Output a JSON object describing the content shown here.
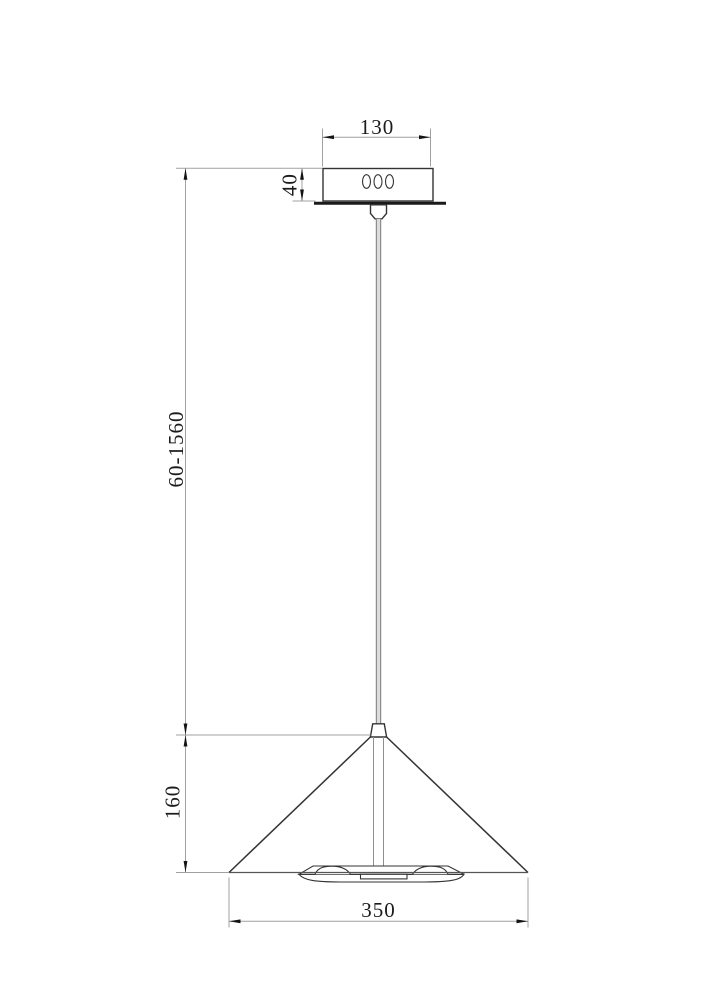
{
  "drawing": {
    "kind": "pendant-lamp-dimension-drawing",
    "dimensions": {
      "canopy_width": "130",
      "canopy_height": "40",
      "suspension_length": "60-1560",
      "shade_height": "160",
      "shade_diameter": "350"
    }
  },
  "colors": {
    "line": "#333333",
    "thick": "#1a1a1a",
    "dim": "#a1a1a1",
    "arrow": "#141414",
    "text": "#1c1c1c",
    "cable": "#dcdcdc",
    "cable-edge": "#7a7a7a",
    "stem": "#8f8f8f",
    "bg": "#ffffff"
  }
}
